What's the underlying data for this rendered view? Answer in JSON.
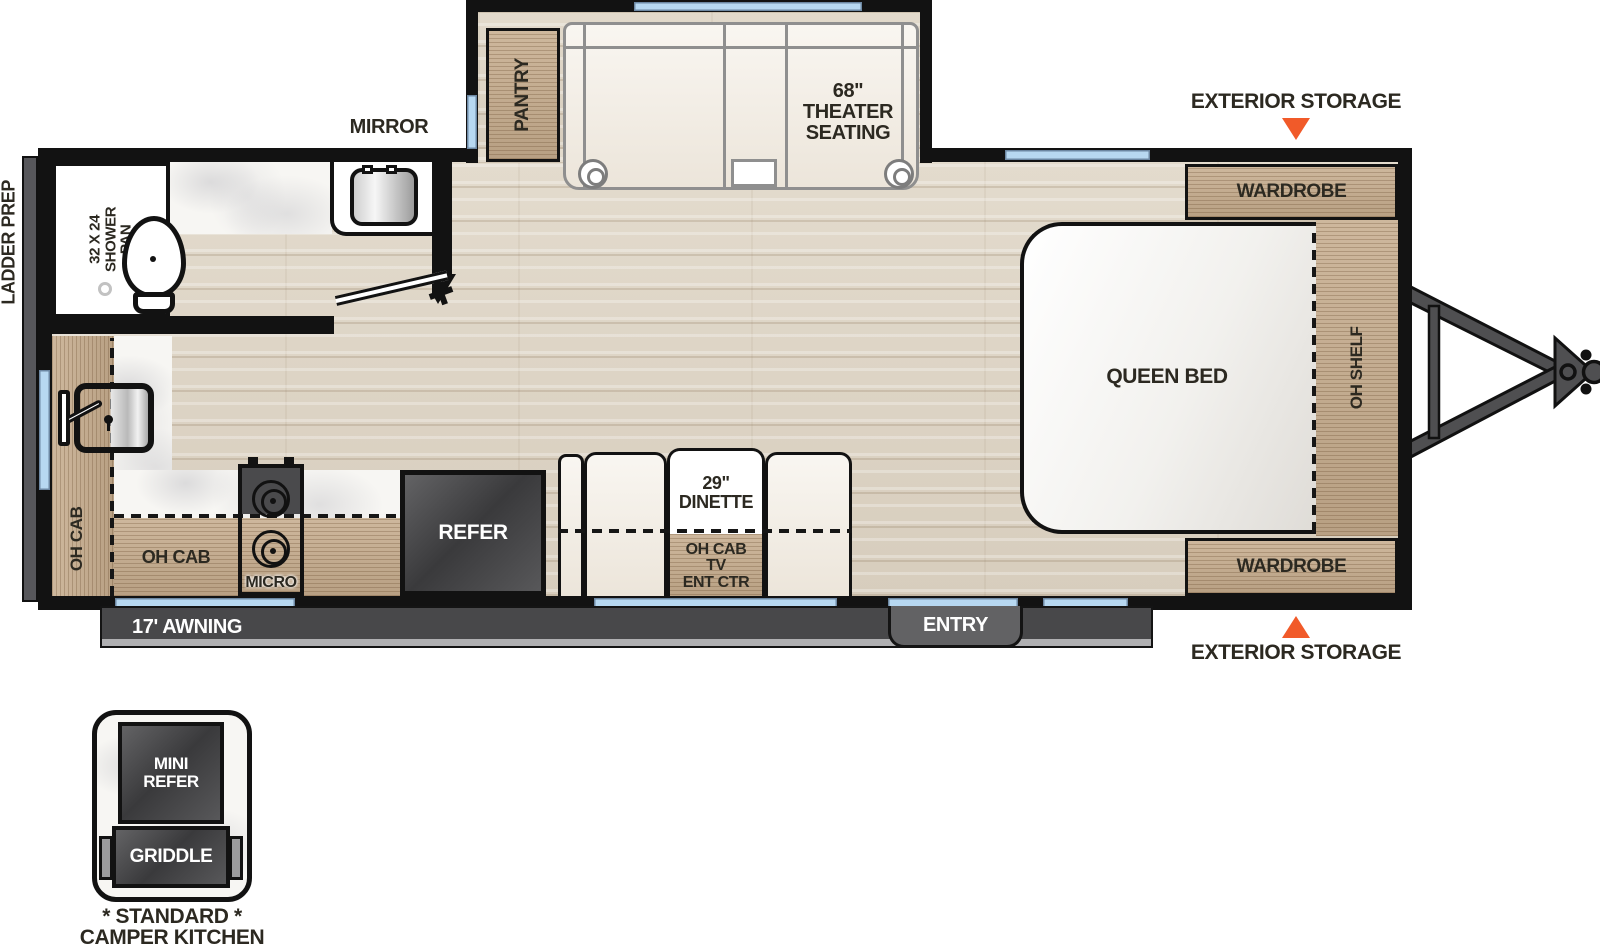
{
  "title": "Travel Trailer Floor Plan",
  "colors": {
    "wall": "#121212",
    "wood": "#c6ac8d",
    "floor": "#ddd4c5",
    "window": "#b7d8f1",
    "storage_marker": "#f15a29",
    "appliance_dark": "#4a4a4c",
    "awning_bar": "#48484a"
  },
  "exterior": {
    "ladder_prep": "LADDER PREP",
    "awning": "17' AWNING",
    "entry": "ENTRY",
    "storage_top": "EXTERIOR STORAGE",
    "storage_bottom": "EXTERIOR STORAGE"
  },
  "slideout": {
    "pantry": "PANTRY",
    "theater_seating": [
      "68\"",
      "THEATER",
      "SEATING"
    ]
  },
  "bathroom": {
    "mirror": "MIRROR",
    "shower_pan": [
      "32 X 24",
      "SHOWER",
      "PAN"
    ]
  },
  "kitchen": {
    "oh_cab_side": "OH CAB",
    "oh_cab_galley": "OH CAB",
    "micro": "MICRO",
    "refer": "REFER"
  },
  "dinette": {
    "size": [
      "29\"",
      "DINETTE"
    ],
    "ent_ctr": [
      "OH CAB",
      "TV",
      "ENT CTR"
    ]
  },
  "bedroom": {
    "queen_bed": "QUEEN BED",
    "oh_shelf": "OH SHELF",
    "wardrobe_top": "WARDROBE",
    "wardrobe_bottom": "WARDROBE"
  },
  "camper_kitchen": {
    "mini_refer": [
      "MINI",
      "REFER"
    ],
    "griddle": "GRIDDLE",
    "caption_line1": "* STANDARD *",
    "caption_line2": "CAMPER KITCHEN"
  }
}
